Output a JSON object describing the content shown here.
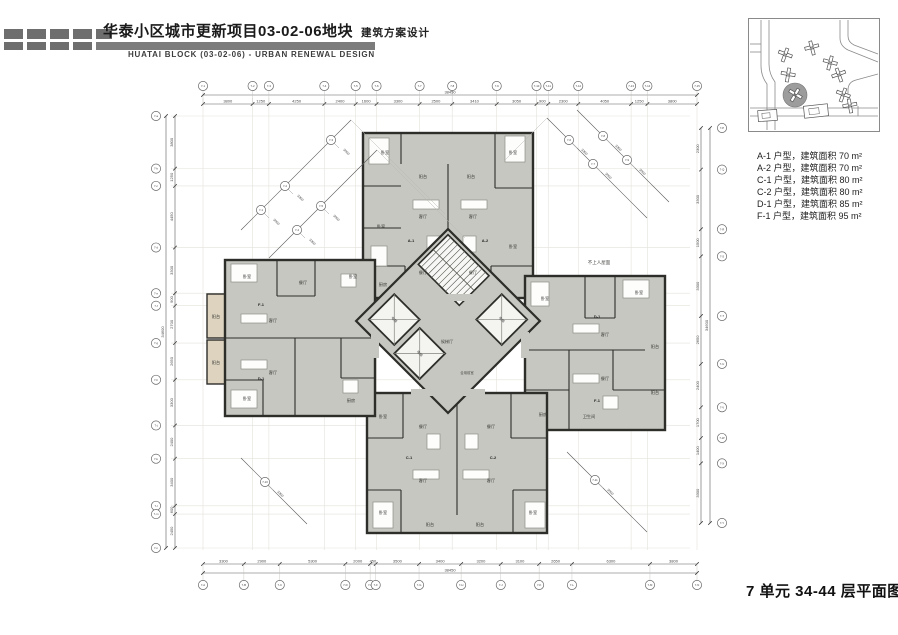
{
  "header": {
    "title": "华泰小区城市更新项目03-02-06地块",
    "title_suffix": "建筑方案设计",
    "subtitle": "HUATAI BLOCK (03-02-06) - URBAN RENEWAL DESIGN"
  },
  "legend": {
    "items": [
      "A-1 户型，建筑面积 70 m²",
      "A-2 户型，建筑面积 70 m²",
      "C-1 户型，建筑面积 80 m²",
      "C-2 户型，建筑面积 80 m²",
      "D-1 户型，建筑面积 85 m²",
      "F-1 户型，建筑面积 95 m²"
    ]
  },
  "plan_title": "7 单元 34-44 层平面图",
  "plan": {
    "colors": {
      "wall": "#2d2d2a",
      "floor": "#c6c7c1",
      "balcony": "#ddd3bf",
      "dim": "#5a5a5a",
      "grid": "#e4e2db",
      "furniture": "#fdfdfc"
    },
    "dims": {
      "top": {
        "values": [
          "3800",
          "1250",
          "4250",
          "2400",
          "1600",
          "3300",
          "2500",
          "3410",
          "3050",
          "900",
          "2300",
          "4050",
          "1250",
          "3800"
        ],
        "total": "38450",
        "bubbles": [
          "7-1",
          "7-2",
          "7-3",
          "7-4",
          "7-5",
          "7-6",
          "7-7",
          "7-8",
          "7-9",
          "7-10",
          "7-11",
          "7-12",
          "7-13",
          "7-14",
          "7-15"
        ]
      },
      "bottom": {
        "values": [
          "3300",
          "2900",
          "5300",
          "2000",
          "450",
          "3500",
          "3400",
          "3200",
          "3100",
          "2650",
          "6300",
          "3800"
        ],
        "total": "38450",
        "bubbles": [
          "7-A",
          "7-B",
          "7-C",
          "7-D",
          "7-E",
          "7-F",
          "7-G",
          "7-H",
          "7-J",
          "7-K",
          "7-L",
          "7-M",
          "7-N"
        ]
      },
      "left": {
        "values": [
          "3800",
          "1250",
          "4450",
          "3300",
          "900",
          "2700",
          "2650",
          "3300",
          "2400",
          "3400",
          "600",
          "2450"
        ],
        "total": "34600",
        "bubbles": [
          "7-a",
          "7-b",
          "7-c",
          "7-d",
          "7-e",
          "7-f",
          "7-g",
          "7-h",
          "7-j",
          "7-k",
          "7-l",
          "7-m",
          "7-n"
        ]
      },
      "right": {
        "values": [
          "2300",
          "3300",
          "1500",
          "3300",
          "2650",
          "2400",
          "1700",
          "1400",
          "3300"
        ],
        "total": "34600",
        "bubbles": [
          "7-P",
          "7-Q",
          "7-R",
          "7-S",
          "7-T",
          "7-U",
          "7-V",
          "7-W",
          "7-X",
          "7-Y"
        ]
      }
    },
    "diag_values": [
      "3000",
      "3300",
      "3000",
      "3300",
      "3000",
      "3300"
    ],
    "diag_labels": [
      "7-1",
      "7-2",
      "7-3",
      "7-4",
      "7-5",
      "7-6",
      "7-7",
      "7-8",
      "7-9",
      "7-10",
      "7-11"
    ],
    "rooms": [
      {
        "t": "卧室",
        "x": 240,
        "y": 76
      },
      {
        "t": "阳台",
        "x": 278,
        "y": 100
      },
      {
        "t": "阳台",
        "x": 326,
        "y": 100
      },
      {
        "t": "客厅",
        "x": 278,
        "y": 140
      },
      {
        "t": "客厅",
        "x": 328,
        "y": 140
      },
      {
        "t": "餐厅",
        "x": 278,
        "y": 196
      },
      {
        "t": "餐厅",
        "x": 328,
        "y": 196
      },
      {
        "t": "厨房",
        "x": 238,
        "y": 208
      },
      {
        "t": "卧室",
        "x": 368,
        "y": 76
      },
      {
        "t": "卧室",
        "x": 368,
        "y": 170
      },
      {
        "t": "卧室",
        "x": 236,
        "y": 150
      },
      {
        "t": "卧室",
        "x": 494,
        "y": 216
      },
      {
        "t": "阳台",
        "x": 510,
        "y": 270
      },
      {
        "t": "阳台",
        "x": 510,
        "y": 316
      },
      {
        "t": "客厅",
        "x": 460,
        "y": 258
      },
      {
        "t": "餐厅",
        "x": 460,
        "y": 302
      },
      {
        "t": "卧室",
        "x": 400,
        "y": 222
      },
      {
        "t": "厨房",
        "x": 398,
        "y": 338
      },
      {
        "t": "卫生间",
        "x": 444,
        "y": 340
      },
      {
        "t": "餐厅",
        "x": 278,
        "y": 350
      },
      {
        "t": "餐厅",
        "x": 346,
        "y": 350
      },
      {
        "t": "客厅",
        "x": 278,
        "y": 404
      },
      {
        "t": "客厅",
        "x": 346,
        "y": 404
      },
      {
        "t": "卧室",
        "x": 238,
        "y": 436
      },
      {
        "t": "卧室",
        "x": 388,
        "y": 436
      },
      {
        "t": "阳台",
        "x": 285,
        "y": 448
      },
      {
        "t": "阳台",
        "x": 335,
        "y": 448
      },
      {
        "t": "卧室",
        "x": 238,
        "y": 340
      },
      {
        "t": "卧室",
        "x": 102,
        "y": 200
      },
      {
        "t": "餐厅",
        "x": 158,
        "y": 206
      },
      {
        "t": "卧室",
        "x": 208,
        "y": 200
      },
      {
        "t": "阳台",
        "x": 71,
        "y": 240
      },
      {
        "t": "阳台",
        "x": 71,
        "y": 286
      },
      {
        "t": "客厅",
        "x": 128,
        "y": 244
      },
      {
        "t": "客厅",
        "x": 128,
        "y": 296
      },
      {
        "t": "厨房",
        "x": 206,
        "y": 324
      },
      {
        "t": "卧室",
        "x": 102,
        "y": 322
      }
    ],
    "unit_tags": [
      {
        "t": "A-1",
        "x": 266,
        "y": 164
      },
      {
        "t": "A-2",
        "x": 340,
        "y": 164
      },
      {
        "t": "D-1",
        "x": 452,
        "y": 240
      },
      {
        "t": "F-1",
        "x": 452,
        "y": 324
      },
      {
        "t": "C-1",
        "x": 264,
        "y": 381
      },
      {
        "t": "C-2",
        "x": 348,
        "y": 381
      },
      {
        "t": "F-1",
        "x": 116,
        "y": 228
      },
      {
        "t": "D-1",
        "x": 116,
        "y": 302
      }
    ],
    "core_labels": [
      {
        "t": "候梯厅",
        "x": 302,
        "y": 265,
        "s": 4.2
      },
      {
        "t": "合用前室",
        "x": 322,
        "y": 296,
        "s": 3.4
      },
      {
        "t": "不上人屋面",
        "x": 454,
        "y": 186,
        "s": 4.5
      }
    ],
    "elevator_label": "电梯",
    "stair_label": "楼梯"
  }
}
